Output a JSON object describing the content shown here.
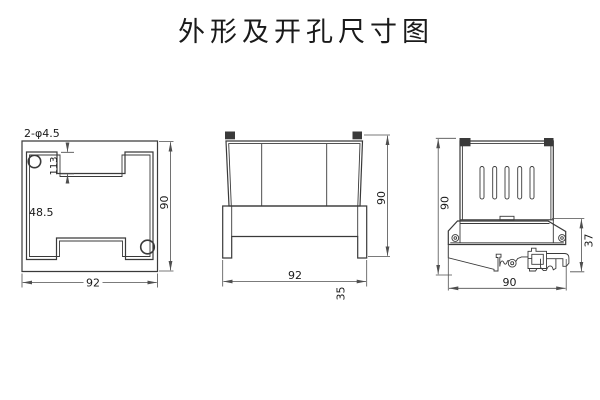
{
  "title": "外形及开孔尺寸图",
  "panel_cutout_view": {
    "hole_callout": "2-φ4.5",
    "notch_depth_dim": "113",
    "side_dim": "48.5",
    "height_dim": "90",
    "width_dim": "92"
  },
  "front_view": {
    "width_dim": "92",
    "height_dim": "90",
    "depth_dim": "35"
  },
  "side_view": {
    "height_dim": "90",
    "lower_height_dim": "37",
    "width_dim": "90"
  },
  "colors": {
    "line": "#3a3a3a",
    "dimension": "#4f4f4f",
    "text": "#1a1a1a",
    "background": "#ffffff"
  }
}
